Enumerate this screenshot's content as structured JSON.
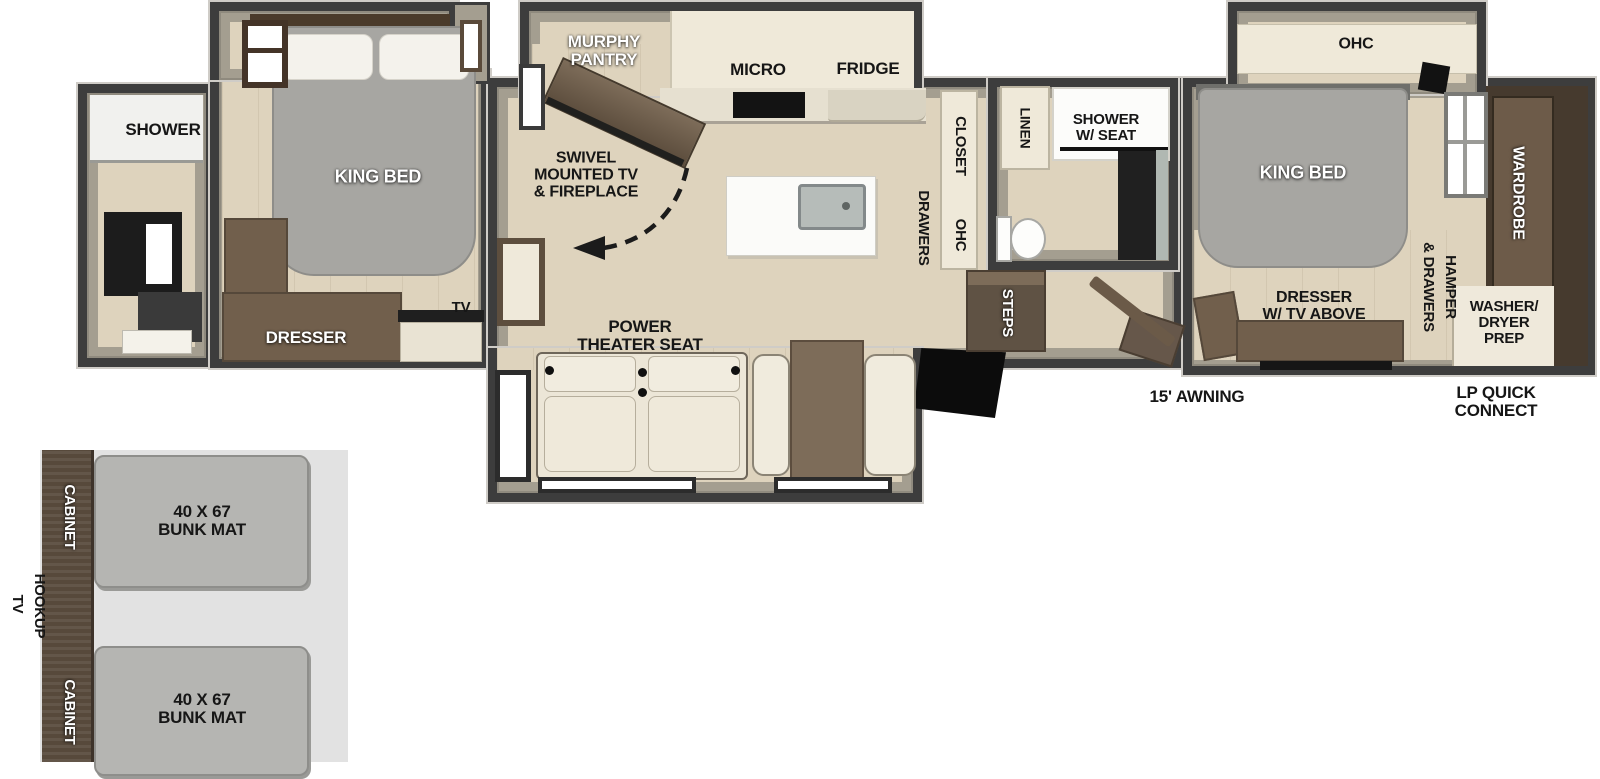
{
  "colors": {
    "wall": "#3d3d3d",
    "wall_edge": "#cfccc7",
    "interior_wall": "#a49e90",
    "floor": "#ded3bd",
    "cream_cabinet": "#efe9d9",
    "brown_furniture": "#715f4c",
    "dark_brown": "#55483a",
    "wardrobe_brown": "#463a2e",
    "bed_gray": "#a7a6a2",
    "seat_cream": "#ece6d7",
    "bunk_mat_gray": "#b5b5b2",
    "inset_bg": "#e2e2e2",
    "label_black": "#161616",
    "label_white": "#ffffff"
  },
  "rear_bath": {
    "shower_label": "SHOWER"
  },
  "bedroom2": {
    "king_bed_label": "KING BED",
    "dresser_label": "DRESSER",
    "tv_label": "TV"
  },
  "kitchen": {
    "murphy_pantry_label": "MURPHY\nPANTRY",
    "micro_label": "MICRO",
    "fridge_label": "FRIDGE",
    "closet_label": "CLOSET",
    "ohc_label": "OHC",
    "drawers_label": "DRAWERS"
  },
  "living": {
    "swivel_tv_label": "SWIVEL\nMOUNTED TV\n& FIREPLACE",
    "power_theater_label": "POWER\nTHEATER SEAT"
  },
  "mid_bath": {
    "linen_label": "LINEN",
    "shower_seat_label": "SHOWER\nW/ SEAT",
    "steps_label": "STEPS"
  },
  "bedroom1": {
    "ohc_label": "OHC",
    "king_bed_label": "KING BED",
    "wardrobe_label": "WARDROBE",
    "hamper_label": "HAMPER",
    "and_drawers_label": "& DRAWERS",
    "dresser_tv_label": "DRESSER\nW/ TV ABOVE",
    "washer_dryer_label": "WASHER/\nDRYER\nPREP"
  },
  "exterior": {
    "awning_label": "15' AWNING",
    "lp_label": "LP QUICK\nCONNECT"
  },
  "bunk_inset": {
    "tv_label": "TV",
    "hookup_label": "HOOKUP",
    "cabinet_top_label": "CABINET",
    "cabinet_bottom_label": "CABINET",
    "mats": [
      {
        "label": "40 X 67\nBUNK MAT"
      },
      {
        "label": "40 X 67\nBUNK MAT"
      }
    ]
  }
}
